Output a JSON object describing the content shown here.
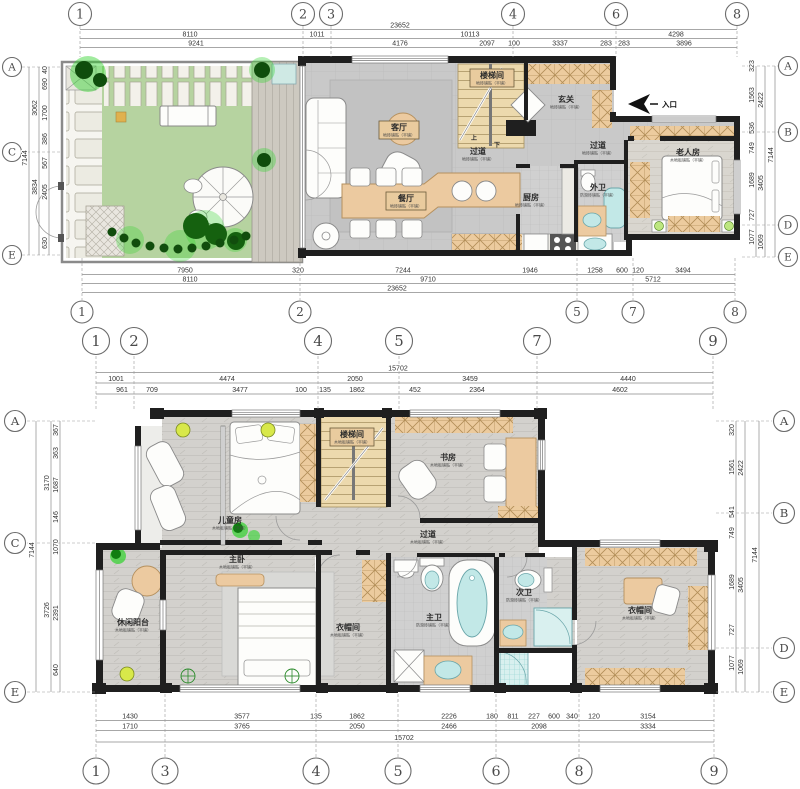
{
  "title": "two-storey residence floor plan",
  "colors": {
    "wall": "#1f1f1f",
    "floor_gray": "#c9c9c9",
    "wood_accent": "#eccaa0",
    "stair_wood": "#ecd9ad",
    "lawn_green": "#b6d3a0",
    "plant_bright": "#2fd32b",
    "plant_dark": "#11520d",
    "fixture_cyan": "#c2e8e7",
    "dim_text": "#333333"
  },
  "floor1": {
    "bubbles": [
      {
        "t": "1",
        "x": 80,
        "y": 14,
        "r": 11.5,
        "axis": "v",
        "lead": [
          26,
          57
        ]
      },
      {
        "t": "2",
        "x": 303,
        "y": 14,
        "r": 11.5,
        "axis": "v",
        "lead": [
          26,
          57
        ]
      },
      {
        "t": "3",
        "x": 331,
        "y": 14,
        "r": 11.5,
        "axis": "v",
        "lead": [
          26,
          57
        ]
      },
      {
        "t": "4",
        "x": 513,
        "y": 14,
        "r": 11.5,
        "axis": "v",
        "lead": [
          26,
          57
        ]
      },
      {
        "t": "6",
        "x": 616,
        "y": 14,
        "r": 11.5,
        "axis": "v",
        "lead": [
          26,
          57
        ]
      },
      {
        "t": "8",
        "x": 737,
        "y": 14,
        "r": 11.5,
        "axis": "v",
        "lead": [
          26,
          57
        ]
      },
      {
        "t": "1",
        "x": 82,
        "y": 312,
        "r": 11,
        "axis": "v",
        "lead": [
          258,
          300
        ]
      },
      {
        "t": "2",
        "x": 300,
        "y": 312,
        "r": 11,
        "axis": "v",
        "lead": [
          258,
          300
        ]
      },
      {
        "t": "5",
        "x": 577,
        "y": 312,
        "r": 11,
        "axis": "v",
        "lead": [
          258,
          300
        ]
      },
      {
        "t": "7",
        "x": 633,
        "y": 312,
        "r": 11,
        "axis": "v",
        "lead": [
          258,
          300
        ]
      },
      {
        "t": "8",
        "x": 735,
        "y": 312,
        "r": 11,
        "axis": "v",
        "lead": [
          258,
          300
        ]
      },
      {
        "t": "A",
        "x": 12,
        "y": 67,
        "r": 9.5,
        "axis": "h",
        "lead": [
          22,
          60
        ]
      },
      {
        "t": "C",
        "x": 12,
        "y": 152,
        "r": 9.5,
        "axis": "h",
        "lead": [
          22,
          60
        ]
      },
      {
        "t": "E",
        "x": 12,
        "y": 255,
        "r": 9.5,
        "axis": "h",
        "lead": [
          22,
          60
        ]
      },
      {
        "t": "A",
        "x": 788,
        "y": 66,
        "r": 9.5,
        "axis": "h",
        "lead": [
          742,
          778
        ]
      },
      {
        "t": "B",
        "x": 788,
        "y": 132,
        "r": 9.5,
        "axis": "h",
        "lead": [
          742,
          778
        ]
      },
      {
        "t": "D",
        "x": 788,
        "y": 225,
        "r": 9.5,
        "axis": "h",
        "lead": [
          742,
          778
        ]
      },
      {
        "t": "E",
        "x": 788,
        "y": 257,
        "r": 9.5,
        "axis": "h",
        "lead": [
          742,
          778
        ]
      }
    ],
    "dims": [
      {
        "t": "23652",
        "x": 400,
        "y": 27.5
      },
      {
        "t": "8110",
        "x": 190,
        "y": 36.5
      },
      {
        "t": "1011",
        "x": 317,
        "y": 36.5
      },
      {
        "t": "10113",
        "x": 470,
        "y": 36.5
      },
      {
        "t": "4298",
        "x": 676,
        "y": 36.5
      },
      {
        "t": "9241",
        "x": 196,
        "y": 45.5
      },
      {
        "t": "4176",
        "x": 400,
        "y": 45.5
      },
      {
        "t": "2097",
        "x": 487,
        "y": 45.5
      },
      {
        "t": "100",
        "x": 514,
        "y": 45.5
      },
      {
        "t": "3337",
        "x": 560,
        "y": 45.5
      },
      {
        "t": "283",
        "x": 606,
        "y": 45.5
      },
      {
        "t": "283",
        "x": 624,
        "y": 45.5
      },
      {
        "t": "3896",
        "x": 684,
        "y": 45.5
      },
      {
        "t": "7950",
        "x": 185,
        "y": 272.5
      },
      {
        "t": "320",
        "x": 298,
        "y": 272.5
      },
      {
        "t": "7244",
        "x": 403,
        "y": 272.5
      },
      {
        "t": "1946",
        "x": 530,
        "y": 272.5
      },
      {
        "t": "1258",
        "x": 595,
        "y": 272.5
      },
      {
        "t": "600",
        "x": 622,
        "y": 272.5
      },
      {
        "t": "120",
        "x": 638,
        "y": 272.5
      },
      {
        "t": "3494",
        "x": 683,
        "y": 272.5
      },
      {
        "t": "8110",
        "x": 190,
        "y": 281.5
      },
      {
        "t": "9710",
        "x": 428,
        "y": 281.5
      },
      {
        "t": "5712",
        "x": 653,
        "y": 281.5
      },
      {
        "t": "23652",
        "x": 397,
        "y": 290.5
      },
      {
        "t": "40",
        "x": 47,
        "y": 70,
        "rot": true
      },
      {
        "t": "690",
        "x": 47,
        "y": 84,
        "rot": true
      },
      {
        "t": "1700",
        "x": 47,
        "y": 113,
        "rot": true
      },
      {
        "t": "386",
        "x": 47,
        "y": 139,
        "rot": true
      },
      {
        "t": "567",
        "x": 47,
        "y": 163,
        "rot": true
      },
      {
        "t": "2405",
        "x": 47,
        "y": 192,
        "rot": true
      },
      {
        "t": "630",
        "x": 47,
        "y": 243,
        "rot": true
      },
      {
        "t": "3062",
        "x": 37,
        "y": 108,
        "rot": true
      },
      {
        "t": "3834",
        "x": 37,
        "y": 187,
        "rot": true
      },
      {
        "t": "7144",
        "x": 27,
        "y": 158,
        "rot": true
      },
      {
        "t": "323",
        "x": 754,
        "y": 66,
        "rot": true
      },
      {
        "t": "1563",
        "x": 754,
        "y": 95,
        "rot": true
      },
      {
        "t": "536",
        "x": 754,
        "y": 128,
        "rot": true
      },
      {
        "t": "749",
        "x": 754,
        "y": 148,
        "rot": true
      },
      {
        "t": "1689",
        "x": 754,
        "y": 180,
        "rot": true
      },
      {
        "t": "727",
        "x": 754,
        "y": 215,
        "rot": true
      },
      {
        "t": "1077",
        "x": 754,
        "y": 237,
        "rot": true
      },
      {
        "t": "2422",
        "x": 763,
        "y": 100,
        "rot": true
      },
      {
        "t": "3405",
        "x": 763,
        "y": 183,
        "rot": true
      },
      {
        "t": "1069",
        "x": 763,
        "y": 242,
        "rot": true
      },
      {
        "t": "7144",
        "x": 773,
        "y": 155,
        "rot": true
      }
    ],
    "rooms": [
      {
        "t": "客厅",
        "sub": "地砖铺贴（平铺）",
        "x": 399,
        "y": 130,
        "box": true
      },
      {
        "t": "餐厅",
        "sub": "地砖铺贴（平铺）",
        "x": 406,
        "y": 201,
        "box": true
      },
      {
        "t": "楼梯间",
        "sub": "地砖铺贴（平铺）",
        "x": 492,
        "y": 78,
        "box": true
      },
      {
        "t": "玄关",
        "sub": "地砖铺贴（平铺）",
        "x": 566,
        "y": 102
      },
      {
        "t": "过道",
        "sub": "地砖铺贴（平铺）",
        "x": 478,
        "y": 154
      },
      {
        "t": "过道",
        "sub": "地砖铺贴（平铺）",
        "x": 598,
        "y": 148
      },
      {
        "t": "厨房",
        "sub": "地砖铺贴（平铺）",
        "x": 531,
        "y": 200
      },
      {
        "t": "外卫",
        "sub": "防滑砖铺贴（平铺）",
        "x": 598,
        "y": 190
      },
      {
        "t": "老人房",
        "sub": "木地板铺贴（平铺）",
        "x": 688,
        "y": 155
      },
      {
        "t": "上",
        "x": 474,
        "y": 140,
        "tiny": true
      },
      {
        "t": "下",
        "x": 497,
        "y": 147,
        "tiny": true
      }
    ],
    "entry_label": "入口"
  },
  "floor2": {
    "bubbles": [
      {
        "t": "1",
        "x": 96,
        "y": 341,
        "r": 13.5,
        "axis": "v",
        "lead": [
          356,
          410
        ]
      },
      {
        "t": "2",
        "x": 134,
        "y": 341,
        "r": 13.5,
        "axis": "v",
        "lead": [
          356,
          410
        ]
      },
      {
        "t": "4",
        "x": 318,
        "y": 341,
        "r": 13.5,
        "axis": "v",
        "lead": [
          356,
          410
        ]
      },
      {
        "t": "5",
        "x": 399,
        "y": 341,
        "r": 13.5,
        "axis": "v",
        "lead": [
          356,
          410
        ]
      },
      {
        "t": "7",
        "x": 537,
        "y": 341,
        "r": 13.5,
        "axis": "v",
        "lead": [
          356,
          410
        ]
      },
      {
        "t": "9",
        "x": 713,
        "y": 341,
        "r": 13.5,
        "axis": "v",
        "lead": [
          356,
          410
        ]
      },
      {
        "t": "1",
        "x": 96,
        "y": 771,
        "r": 13,
        "axis": "v",
        "lead": [
          694,
          757
        ]
      },
      {
        "t": "3",
        "x": 165,
        "y": 771,
        "r": 13,
        "axis": "v",
        "lead": [
          694,
          757
        ]
      },
      {
        "t": "4",
        "x": 316,
        "y": 771,
        "r": 13,
        "axis": "v",
        "lead": [
          694,
          757
        ]
      },
      {
        "t": "5",
        "x": 398,
        "y": 771,
        "r": 13,
        "axis": "v",
        "lead": [
          694,
          757
        ]
      },
      {
        "t": "6",
        "x": 496,
        "y": 771,
        "r": 13,
        "axis": "v",
        "lead": [
          694,
          757
        ]
      },
      {
        "t": "8",
        "x": 579,
        "y": 771,
        "r": 13,
        "axis": "v",
        "lead": [
          694,
          757
        ]
      },
      {
        "t": "9",
        "x": 714,
        "y": 771,
        "r": 13,
        "axis": "v",
        "lead": [
          694,
          757
        ]
      },
      {
        "t": "A",
        "x": 15,
        "y": 421,
        "r": 10.5,
        "axis": "h",
        "lead": [
          27,
          95
        ]
      },
      {
        "t": "C",
        "x": 15,
        "y": 543,
        "r": 10.5,
        "axis": "h",
        "lead": [
          27,
          95
        ]
      },
      {
        "t": "E",
        "x": 15,
        "y": 692,
        "r": 10.5,
        "axis": "h",
        "lead": [
          27,
          95
        ]
      },
      {
        "t": "A",
        "x": 784,
        "y": 421,
        "r": 10.5,
        "axis": "h",
        "lead": [
          716,
          772
        ]
      },
      {
        "t": "B",
        "x": 784,
        "y": 513,
        "r": 10.5,
        "axis": "h",
        "lead": [
          716,
          772
        ]
      },
      {
        "t": "D",
        "x": 784,
        "y": 648,
        "r": 10.5,
        "axis": "h",
        "lead": [
          716,
          772
        ]
      },
      {
        "t": "E",
        "x": 784,
        "y": 692,
        "r": 10.5,
        "axis": "h",
        "lead": [
          716,
          772
        ]
      }
    ],
    "dims": [
      {
        "t": "15702",
        "x": 398,
        "y": 370.5
      },
      {
        "t": "1001",
        "x": 116,
        "y": 381
      },
      {
        "t": "4474",
        "x": 227,
        "y": 381
      },
      {
        "t": "2050",
        "x": 355,
        "y": 381
      },
      {
        "t": "3459",
        "x": 470,
        "y": 381
      },
      {
        "t": "4440",
        "x": 628,
        "y": 381
      },
      {
        "t": "961",
        "x": 122,
        "y": 392
      },
      {
        "t": "709",
        "x": 152,
        "y": 392
      },
      {
        "t": "3477",
        "x": 240,
        "y": 392
      },
      {
        "t": "100",
        "x": 301,
        "y": 392
      },
      {
        "t": "135",
        "x": 325,
        "y": 392
      },
      {
        "t": "1862",
        "x": 357,
        "y": 392
      },
      {
        "t": "452",
        "x": 415,
        "y": 392
      },
      {
        "t": "2364",
        "x": 477,
        "y": 392
      },
      {
        "t": "4602",
        "x": 620,
        "y": 392
      },
      {
        "t": "1430",
        "x": 130,
        "y": 718.5
      },
      {
        "t": "3577",
        "x": 242,
        "y": 718.5
      },
      {
        "t": "135",
        "x": 316,
        "y": 718.5
      },
      {
        "t": "1862",
        "x": 357,
        "y": 718.5
      },
      {
        "t": "2226",
        "x": 449,
        "y": 718.5
      },
      {
        "t": "180",
        "x": 492,
        "y": 718.5
      },
      {
        "t": "811",
        "x": 513,
        "y": 718.5
      },
      {
        "t": "227",
        "x": 534,
        "y": 718.5
      },
      {
        "t": "600",
        "x": 554,
        "y": 718.5
      },
      {
        "t": "340",
        "x": 572,
        "y": 718.5
      },
      {
        "t": "120",
        "x": 594,
        "y": 718.5
      },
      {
        "t": "3154",
        "x": 648,
        "y": 718.5
      },
      {
        "t": "1710",
        "x": 130,
        "y": 728.5
      },
      {
        "t": "3765",
        "x": 242,
        "y": 728.5
      },
      {
        "t": "2050",
        "x": 357,
        "y": 728.5
      },
      {
        "t": "2466",
        "x": 449,
        "y": 728.5
      },
      {
        "t": "2098",
        "x": 539,
        "y": 728.5
      },
      {
        "t": "3334",
        "x": 648,
        "y": 728.5
      },
      {
        "t": "15702",
        "x": 404,
        "y": 740
      },
      {
        "t": "367",
        "x": 58,
        "y": 430,
        "rot": true
      },
      {
        "t": "363",
        "x": 58,
        "y": 453,
        "rot": true
      },
      {
        "t": "1687",
        "x": 58,
        "y": 485,
        "rot": true
      },
      {
        "t": "146",
        "x": 58,
        "y": 517,
        "rot": true
      },
      {
        "t": "1070",
        "x": 58,
        "y": 547,
        "rot": true
      },
      {
        "t": "2391",
        "x": 58,
        "y": 613,
        "rot": true
      },
      {
        "t": "640",
        "x": 58,
        "y": 670,
        "rot": true
      },
      {
        "t": "3170",
        "x": 49,
        "y": 483,
        "rot": true
      },
      {
        "t": "3726",
        "x": 49,
        "y": 610,
        "rot": true
      },
      {
        "t": "7144",
        "x": 34,
        "y": 550,
        "rot": true
      },
      {
        "t": "320",
        "x": 734,
        "y": 430,
        "rot": true
      },
      {
        "t": "1561",
        "x": 734,
        "y": 467,
        "rot": true
      },
      {
        "t": "541",
        "x": 734,
        "y": 512,
        "rot": true
      },
      {
        "t": "749",
        "x": 734,
        "y": 533,
        "rot": true
      },
      {
        "t": "1689",
        "x": 734,
        "y": 582,
        "rot": true
      },
      {
        "t": "727",
        "x": 734,
        "y": 630,
        "rot": true
      },
      {
        "t": "1077",
        "x": 734,
        "y": 663,
        "rot": true
      },
      {
        "t": "2422",
        "x": 743,
        "y": 468,
        "rot": true
      },
      {
        "t": "3405",
        "x": 743,
        "y": 585,
        "rot": true
      },
      {
        "t": "1069",
        "x": 743,
        "y": 667,
        "rot": true
      },
      {
        "t": "7144",
        "x": 757,
        "y": 555,
        "rot": true
      }
    ],
    "rooms": [
      {
        "t": "儿童房",
        "sub": "木地板铺贴（平铺）",
        "x": 230,
        "y": 523
      },
      {
        "t": "楼梯间",
        "sub": "木地板铺贴（平铺）",
        "x": 352,
        "y": 437,
        "box": true
      },
      {
        "t": "书房",
        "sub": "木地板铺贴（平铺）",
        "x": 448,
        "y": 460
      },
      {
        "t": "过道",
        "sub": "木地板铺贴（平铺）",
        "x": 428,
        "y": 537
      },
      {
        "t": "主卧",
        "sub": "木地板铺贴（平铺）",
        "x": 237,
        "y": 562
      },
      {
        "t": "休闲阳台",
        "sub": "木地板铺贴（平铺）",
        "x": 133,
        "y": 625
      },
      {
        "t": "衣帽间",
        "sub": "木地板铺贴（平铺）",
        "x": 348,
        "y": 630
      },
      {
        "t": "主卫",
        "sub": "防滑砖铺贴（平铺）",
        "x": 434,
        "y": 620
      },
      {
        "t": "次卫",
        "sub": "防滑砖铺贴（平铺）",
        "x": 524,
        "y": 595
      },
      {
        "t": "衣帽间",
        "sub": "木地板铺贴（平铺）",
        "x": 640,
        "y": 613
      }
    ]
  }
}
